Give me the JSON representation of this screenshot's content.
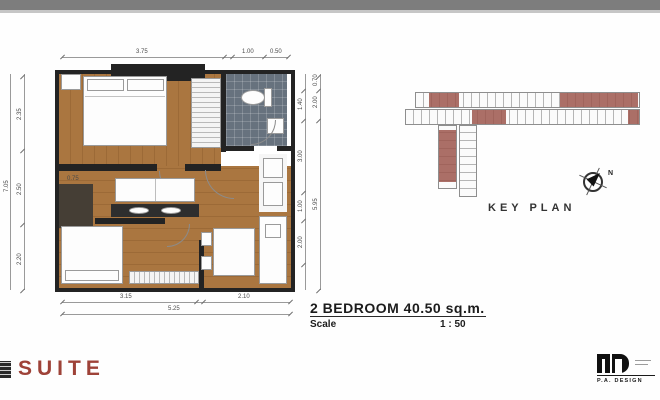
{
  "title_block": {
    "title": "2 BEDROOM 40.50 sq.m.",
    "scale_label": "Scale",
    "scale_value": "1 : 50"
  },
  "key_plan": {
    "label": "KEY PLAN",
    "north_label": "N",
    "highlight_color": "#9c564c"
  },
  "branding": {
    "suite_text": "SUITE",
    "pa_design_text": "P.A. DESIGN"
  },
  "dims": {
    "top": [
      "3.75",
      "1.00",
      "0.50"
    ],
    "bottom": [
      "3.15",
      "2.10"
    ],
    "bottom_total": "5.25",
    "left": [
      "2.35",
      "2.50",
      "2.20"
    ],
    "left_total": "7.05",
    "right_inner": [
      "1.40",
      "3.00",
      "1.00",
      "2.00"
    ],
    "right_outer": [
      "0.70",
      "2.00",
      "5.95"
    ],
    "interior": [
      "0.75"
    ]
  },
  "colors": {
    "wood": "#a8743e",
    "wall": "#232323",
    "bath_tile": "#67727e",
    "suite_red": "#9e4238",
    "band_gray": "#7d7d7d"
  }
}
